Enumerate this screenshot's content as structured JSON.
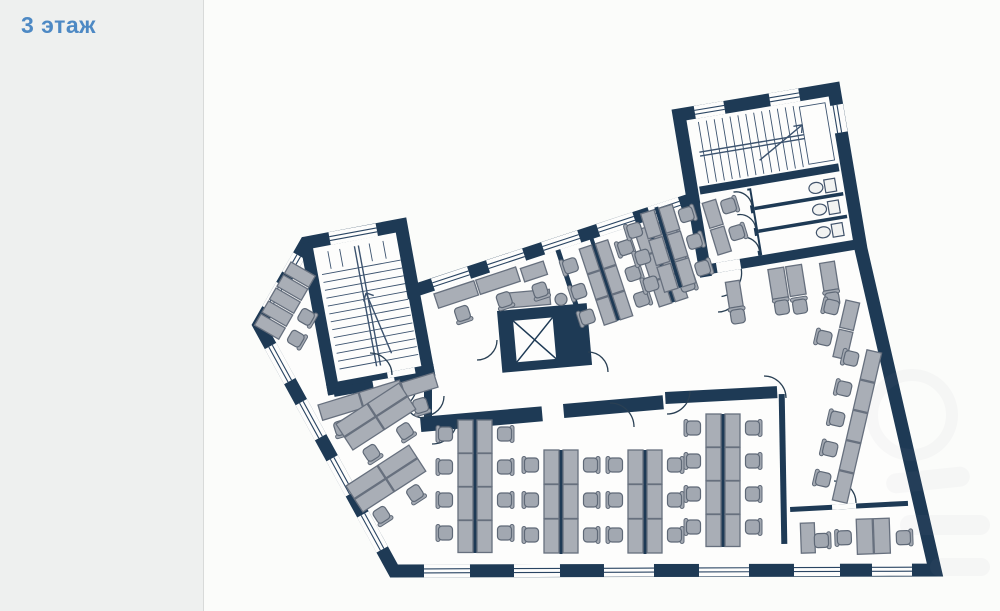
{
  "page": {
    "floor_label": "3 этаж"
  },
  "colors": {
    "accent": "#4d89c4",
    "page_bg": "#eef0ef",
    "plan_bg": "#fbfcfa",
    "wall": "#1e3a55",
    "glazing": "#2a4563",
    "desk": "#a9aeb6",
    "desk_border": "#67707e",
    "chair": "#a2a8b1",
    "chair_border": "#5f6977",
    "tread": "#3c536f",
    "arc": "#2a4054"
  }
}
